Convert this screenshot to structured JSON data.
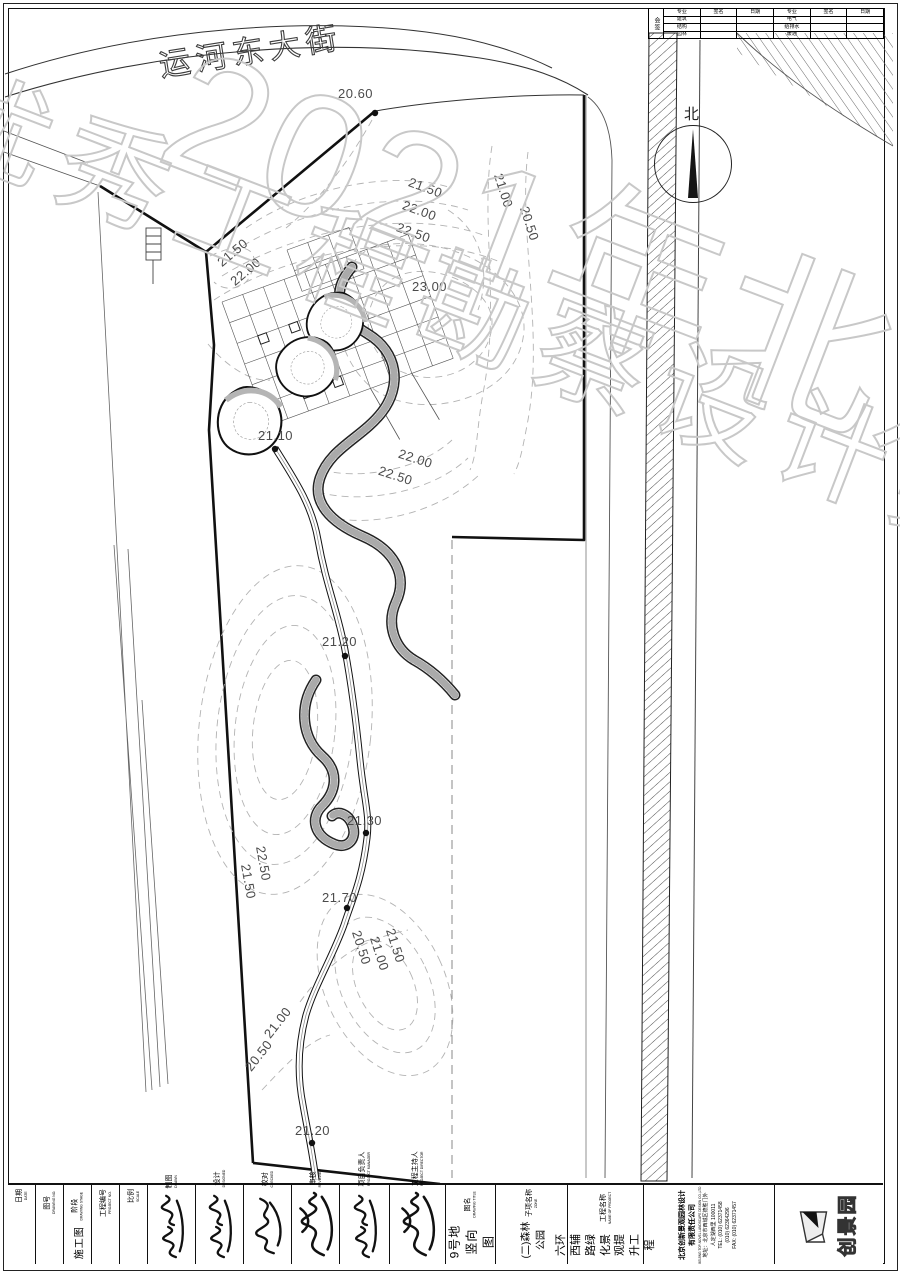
{
  "watermark": {
    "upper": "2021年北京市",
    "lower": "优秀工程勘察设计奖"
  },
  "street": {
    "name": "运河东大街"
  },
  "north_label": "北",
  "sign_table": {
    "corner": "会签",
    "headers": [
      "专业",
      "签名",
      "日期"
    ],
    "left_rows": [
      "建筑",
      "结构",
      "园林"
    ],
    "right_rows": [
      "电气",
      "给排水",
      "暖通"
    ]
  },
  "contour_labels": [
    "20.60",
    "21.50",
    "22.00",
    "22.50",
    "21.00",
    "20.50",
    "21.50",
    "22.00",
    "23.00",
    "21.10",
    "22.00",
    "22.50",
    "21.20",
    "21.30",
    "21.70",
    "22.50",
    "21.50",
    "21.50",
    "21.00",
    "20.50",
    "21.00",
    "20.50",
    "21.20"
  ],
  "titleblock": {
    "cols": [
      {
        "label": "日期",
        "en": "DATE",
        "value": ""
      },
      {
        "label": "图号",
        "en": "DRAWING NO.",
        "value": ""
      },
      {
        "label": "阶段",
        "en": "DRAWING STAGE",
        "value": "施工图"
      },
      {
        "label": "工程编号",
        "en": "PROJECT NO.",
        "value": ""
      },
      {
        "label": "比例",
        "en": "SCALE",
        "value": ""
      },
      {
        "label": "制图",
        "en": "DRAWN",
        "value": ""
      },
      {
        "label": "设计",
        "en": "DESIGNED",
        "value": ""
      },
      {
        "label": "校对",
        "en": "CHECKED",
        "value": ""
      },
      {
        "label": "审核",
        "en": "REVIEWED",
        "value": ""
      },
      {
        "label": "项目负责人",
        "en": "PROJECT MANAGER",
        "value": ""
      },
      {
        "label": "工程主持人",
        "en": "PROJECT DIRECTOR",
        "value": ""
      },
      {
        "label": "图名",
        "en": "DRAWING TITLE",
        "value": "9号地竖向图"
      },
      {
        "label": "子项名称",
        "en": "ZONE",
        "value": "(二)森林公园"
      },
      {
        "label": "工程名称",
        "en": "NAME OF PROJECT",
        "value": "六环西辅路绿化景观提升工程"
      }
    ]
  },
  "company": {
    "name1": "北京创新景观园林设计",
    "name2": "有限责任公司",
    "en": "BEIJING TOP-NOVEL LANDSCAPE DESIGN CO.,LTD",
    "addr1": "地址：北京市西城区德胜门外",
    "addr2": "人定湖西里 100011",
    "tel1": "TEL: (010) 62371458",
    "tel2": "(010) 62364296",
    "fax": "FAX: (010) 62371457"
  },
  "logo_text": "创景园",
  "colors": {
    "line": "#111111",
    "contour": "#b3b3b3",
    "label": "#4b4b4b",
    "watermark": "#c8c8c8"
  }
}
